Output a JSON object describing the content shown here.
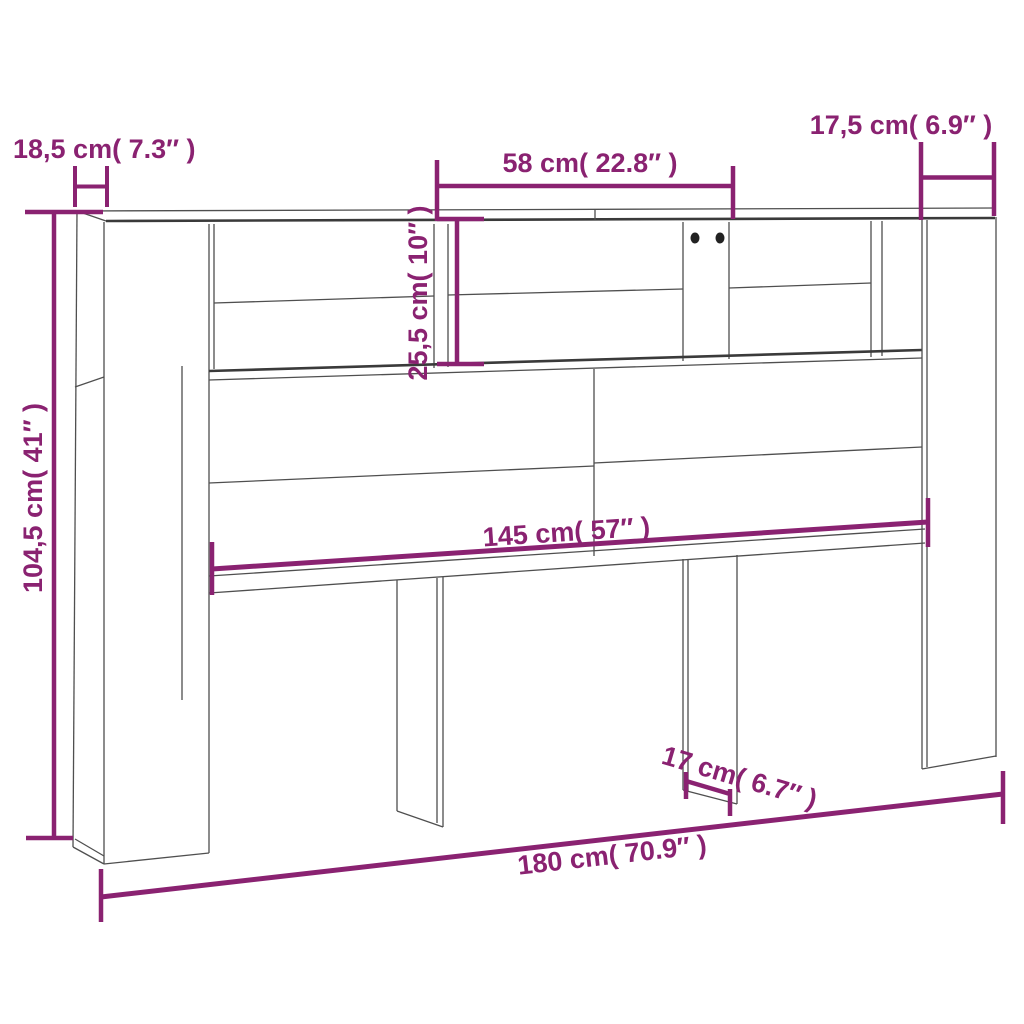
{
  "page": {
    "title": "Headboard cabinet dimension diagram",
    "background_color": "#ffffff"
  },
  "style": {
    "accent_color": "#8a2271",
    "outline_color": "#4f4f4f",
    "hole_color": "#222222"
  },
  "product": {
    "name": "headboard-with-storage-shelves",
    "view": "front perspective line drawing",
    "features": [
      "full-width top board",
      "upper row of open shelf compartments with dividers",
      "two screw holes on center divider",
      "large back panels",
      "four floor-standing leg panels"
    ]
  },
  "dimensions": {
    "depth_top_left": {
      "label": "18,5 cm( 7.3″ )",
      "cm": "18,5",
      "inch": "7.3",
      "orientation": "horizontal"
    },
    "center_compartment_width": {
      "label": "58 cm( 22.8″ )",
      "cm": "58",
      "inch": "22.8",
      "orientation": "horizontal"
    },
    "right_compartment_width": {
      "label": "17,5 cm( 6.9″ )",
      "cm": "17,5",
      "inch": "6.9",
      "orientation": "horizontal"
    },
    "total_height": {
      "label": "104,5 cm( 41″ )",
      "cm": "104,5",
      "inch": "41",
      "orientation": "vertical"
    },
    "shelf_height": {
      "label": "25,5 cm( 10″ )",
      "cm": "25,5",
      "inch": "10",
      "orientation": "vertical"
    },
    "inner_width": {
      "label": "145 cm( 57″ )",
      "cm": "145",
      "inch": "57",
      "orientation": "horizontal"
    },
    "leg_width": {
      "label": "17 cm( 6.7″ )",
      "cm": "17",
      "inch": "6.7",
      "orientation": "horizontal"
    },
    "total_width": {
      "label": "180 cm( 70.9″ )",
      "cm": "180",
      "inch": "70.9",
      "orientation": "horizontal"
    }
  }
}
